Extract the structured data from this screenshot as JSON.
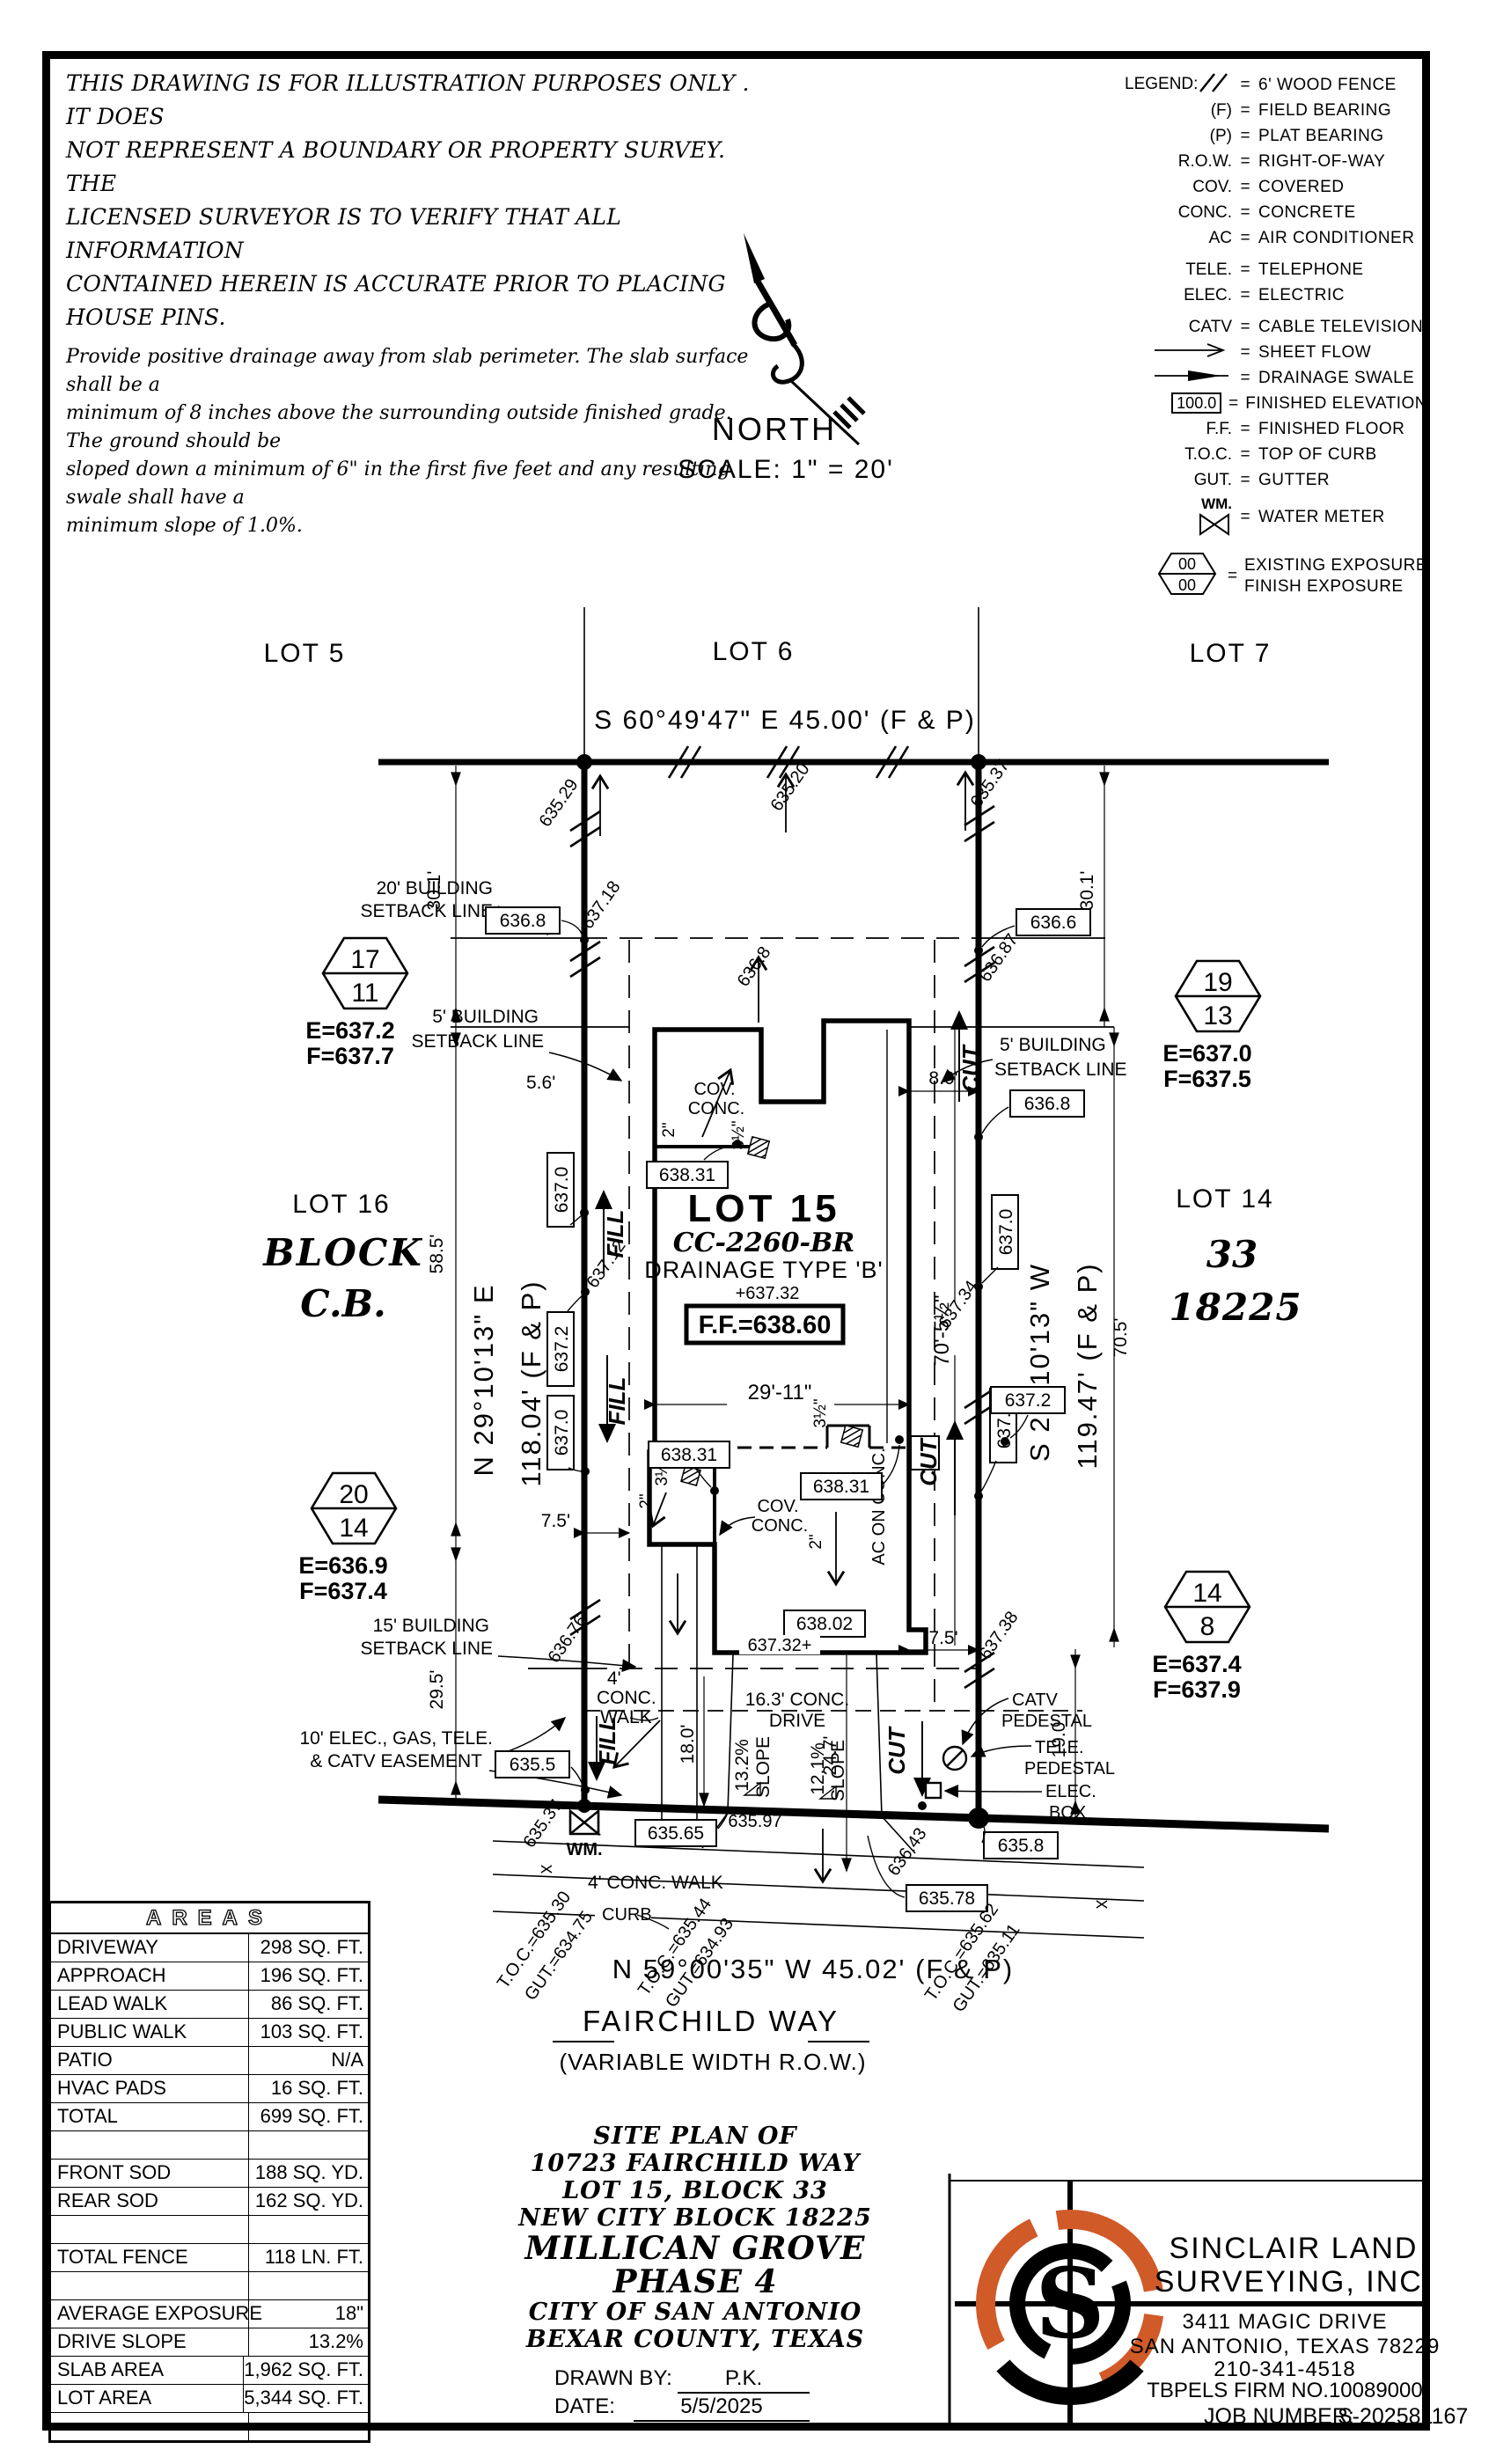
{
  "notes": {
    "para1": [
      "THIS DRAWING IS FOR ILLUSTRATION PURPOSES ONLY . IT DOES",
      "NOT REPRESENT A BOUNDARY OR PROPERTY SURVEY. THE",
      "LICENSED SURVEYOR IS TO VERIFY THAT ALL INFORMATION",
      "CONTAINED HEREIN IS ACCURATE PRIOR TO PLACING HOUSE PINS."
    ],
    "para2": [
      "Provide positive drainage away from slab perimeter. The slab surface shall be a",
      "minimum of 8 inches above the surrounding outside finished grade. The ground should be",
      "sloped down a minimum of 6\" in the first five feet and any resulting swale shall have a",
      "minimum slope of 1.0%."
    ]
  },
  "north": {
    "label": "NORTH",
    "scale": "SCALE: 1\" = 20'"
  },
  "legend": {
    "title": "LEGEND:",
    "eq": "=",
    "wm_key": "WM.",
    "hex_top": "00",
    "hex_bot": "00",
    "items": [
      {
        "key": "",
        "text": "6' WOOD FENCE"
      },
      {
        "key": "(F)",
        "text": "FIELD BEARING"
      },
      {
        "key": "(P)",
        "text": "PLAT BEARING"
      },
      {
        "key": "R.O.W.",
        "text": "RIGHT-OF-WAY"
      },
      {
        "key": "COV.",
        "text": "COVERED"
      },
      {
        "key": "CONC.",
        "text": "CONCRETE"
      },
      {
        "key": "AC",
        "text": "AIR CONDITIONER"
      },
      {
        "key": "TELE.",
        "text": "TELEPHONE"
      },
      {
        "key": "ELEC.",
        "text": "ELECTRIC"
      },
      {
        "key": "CATV",
        "text": "CABLE TELEVISION"
      },
      {
        "key": "",
        "text": "SHEET FLOW"
      },
      {
        "key": "",
        "text": "DRAINAGE SWALE"
      },
      {
        "key": "100.0",
        "text": "FINISHED ELEVATION"
      },
      {
        "key": "F.F.",
        "text": "FINISHED FLOOR"
      },
      {
        "key": "T.O.C.",
        "text": "TOP OF CURB"
      },
      {
        "key": "GUT.",
        "text": "GUTTER"
      },
      {
        "key": "WM.",
        "text": "WATER METER"
      },
      {
        "key": "00 00",
        "text": "EXISTING EXPOSURE",
        "text2": "FINISH EXPOSURE"
      }
    ]
  },
  "lots": {
    "lot5": "LOT 5",
    "lot6": "LOT 6",
    "lot7": "LOT 7",
    "lot16": "LOT 16",
    "block": "BLOCK",
    "cb": "C.B.",
    "lot14": "LOT 14",
    "b33": "33",
    "ncb": "18225"
  },
  "bearings": {
    "top": "S 60°49'47\" E 45.00' (F & P)",
    "left1": "N 29°10'13\" E",
    "left2": "118.04' (F & P)",
    "right1": "S 29°10'13\" W",
    "right2": "119.47' (F & P)",
    "bottom": "N 59°00'35\" W 45.02' (F & P)"
  },
  "street": {
    "name": "FAIRCHILD WAY",
    "row": "(VARIABLE WIDTH R.O.W.)"
  },
  "house": {
    "lot": "LOT 15",
    "plan": "CC-2260-BR",
    "drain": "DRAINAGE TYPE 'B'",
    "spot": "+637.32",
    "ff": "F.F.=638.60",
    "cov1": "COV.",
    "cov2": "CONC.",
    "w": "29'-11\"",
    "h": "70'-5½\"",
    "ac": "AC ON CONC."
  },
  "labels": {
    "sb20a": "20' BUILDING",
    "sb20b": "SETBACK LINE",
    "sb5a": "5' BUILDING",
    "sb5b": "SETBACK LINE",
    "sb15a": "15' BUILDING",
    "sb15b": "SETBACK LINE",
    "easea": "10' ELEC., GAS, TELE.",
    "easeb": "& CATV EASEMENT",
    "drivea": "16.3' CONC.",
    "driveb": "DRIVE",
    "walk4a": "4'",
    "walk4b": "CONC.",
    "walk4c": "WALK",
    "walk4": "4' CONC. WALK",
    "curb": "CURB",
    "slope1a": "13.2%",
    "slope1b": "SLOPE",
    "slope2a": "12.1%",
    "slope2b": "SLOPE",
    "cut": "CUT",
    "fill": "FILL",
    "catv1": "CATV",
    "catv2": "PEDESTAL",
    "tele1": "TELE.",
    "tele2": "PEDESTAL",
    "elec1": "ELEC.",
    "elec2": "BOX",
    "wm": "WM."
  },
  "dims": {
    "d301": "30.1'",
    "d585": "58.5'",
    "d295": "29.5'",
    "d705": "70.5'",
    "d80": "8.0'",
    "d75": "7.5'",
    "d180": "18.0'",
    "d247": "24.7'",
    "d190": "19.0'",
    "d56": "5.6'",
    "d2in": "2\"",
    "d35in": "3½\""
  },
  "boxes": {
    "b6368L": "636.8",
    "b6366": "636.6",
    "b6368R": "636.8",
    "b6370a": "637.0",
    "b6372a": "637.2",
    "b6370b": "637.0",
    "b6370c": "637.0",
    "b6372b": "637.2",
    "b6372c": "637.2",
    "b63831a": "638.31",
    "b63831b": "638.31",
    "b63831c": "638.31",
    "b63802": "638.02",
    "b6355": "635.5",
    "b63565": "635.65",
    "b6358": "635.8",
    "b63578": "635.78"
  },
  "spots": {
    "s63529": "635.29",
    "s63520": "635.20",
    "s63537t": "635.37",
    "s63718": "637.18",
    "s63712": "637.12",
    "s6368": "636.8",
    "s63676": "636.76",
    "s63687": "636.87",
    "s63734": "637.34",
    "s63738": "637.38",
    "s63537b": "635.37",
    "s63643": "636.43",
    "s63597": "635.97",
    "s63732": "637.32+"
  },
  "toc": {
    "t1a": "T.O.C.=635.30",
    "t1b": "GUT.=634.75",
    "t2a": "T.O.C.=635.44",
    "t2b": "GUT.=634.93",
    "t3a": "T.O.C.=635.62",
    "t3b": "GUT.=635.11"
  },
  "hex": [
    {
      "t": "17",
      "b": "11",
      "e": "E=637.2",
      "f": "F=637.7"
    },
    {
      "t": "19",
      "b": "13",
      "e": "E=637.0",
      "f": "F=637.5"
    },
    {
      "t": "20",
      "b": "14",
      "e": "E=636.9",
      "f": "F=637.4"
    },
    {
      "t": "14",
      "b": "8",
      "e": "E=637.4",
      "f": "F=637.9"
    }
  ],
  "areas": {
    "title": "AREAS",
    "rows": [
      {
        "l": "DRIVEWAY",
        "v": "298 SQ. FT."
      },
      {
        "l": "APPROACH",
        "v": "196 SQ. FT."
      },
      {
        "l": "LEAD WALK",
        "v": "86 SQ. FT."
      },
      {
        "l": "PUBLIC WALK",
        "v": "103 SQ. FT."
      },
      {
        "l": "PATIO",
        "v": "N/A"
      },
      {
        "l": "HVAC PADS",
        "v": "16 SQ. FT."
      },
      {
        "l": "TOTAL",
        "v": "699 SQ. FT."
      },
      {
        "l": "",
        "v": ""
      },
      {
        "l": "FRONT SOD",
        "v": "188 SQ. YD."
      },
      {
        "l": "REAR SOD",
        "v": "162 SQ. YD."
      },
      {
        "l": "",
        "v": ""
      },
      {
        "l": "TOTAL FENCE",
        "v": "118 LN. FT."
      },
      {
        "l": "",
        "v": ""
      },
      {
        "l": "AVERAGE EXPOSURE",
        "v": "18\""
      },
      {
        "l": "DRIVE SLOPE",
        "v": "13.2%"
      },
      {
        "l": "SLAB AREA",
        "v": "1,962 SQ. FT."
      },
      {
        "l": "LOT AREA",
        "v": "5,344 SQ. FT."
      },
      {
        "l": "",
        "v": ""
      }
    ]
  },
  "titleblock": {
    "lines": [
      "SITE PLAN OF",
      "10723 FAIRCHILD WAY",
      "LOT 15, BLOCK 33",
      "NEW CITY BLOCK 18225",
      "MILLICAN GROVE",
      "PHASE 4",
      "CITY OF SAN ANTONIO",
      "BEXAR COUNTY, TEXAS"
    ],
    "drawn_label": "DRAWN BY:",
    "drawn": "P.K.",
    "date_label": "DATE:",
    "date": "5/5/2025"
  },
  "company": {
    "name1": "SINCLAIR LAND",
    "name2": "SURVEYING, INC.",
    "addr1": "3411 MAGIC DRIVE",
    "addr2": "SAN ANTONIO, TEXAS 78229",
    "phone": "210-341-4518",
    "firm": "TBPELS FIRM NO.10089000",
    "job_label": "JOB NUMBER:",
    "job": "S-202581167",
    "logo_letter": "S",
    "orange": "#D05A28"
  }
}
